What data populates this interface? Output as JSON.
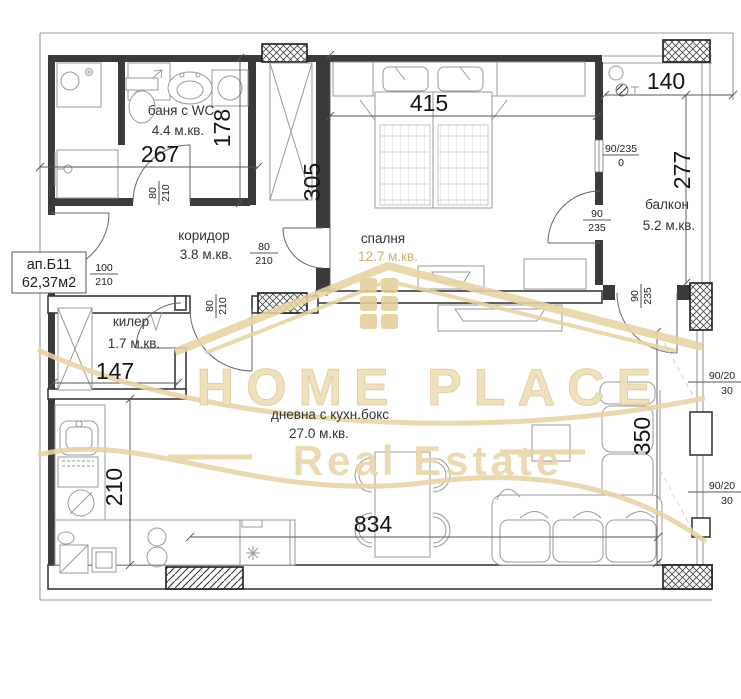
{
  "plan": {
    "unit_label": {
      "line1": "ап.Б11",
      "line2": "62,37м2"
    },
    "rooms": {
      "bathroom": {
        "name": "баня с WC",
        "area": "4.4 м.кв."
      },
      "corridor": {
        "name": "коридор",
        "area": "3.8 м.кв."
      },
      "bedroom": {
        "name": "спалня",
        "area": "12.7 м.кв."
      },
      "balcony": {
        "name": "балкон",
        "area": "5.2 м.кв."
      },
      "storage": {
        "name": "килер",
        "area": "1.7 м.кв."
      },
      "living": {
        "name": "дневна с кухн.бокс",
        "area": "27.0 м.кв."
      }
    },
    "dimensions": {
      "bath_width": "267",
      "bath_depth": "178",
      "bedroom_depth": "305",
      "bedroom_width": "415",
      "balcony_width": "140",
      "balcony_depth": "277",
      "storage_width": "147",
      "kitchen_depth": "210",
      "living_width": "834",
      "living_window": "350"
    },
    "openings": {
      "bath_door": {
        "w": "80",
        "h": "210"
      },
      "bedroom_door": {
        "w": "80",
        "h": "210"
      },
      "entrance_door": {
        "w": "100",
        "h": "210"
      },
      "living_door": {
        "w": "80",
        "h": "210"
      },
      "balcony_window": {
        "w": "90/235",
        "h": "0"
      },
      "bedroom_balcony_door": {
        "w": "90",
        "h": "235"
      },
      "living_balcony_door": {
        "w": "90",
        "h": "235"
      },
      "right_window_top": {
        "w": "90/20",
        "h": "30"
      },
      "right_window_bottom": {
        "w": "90/20",
        "h": "30"
      }
    },
    "watermark": {
      "title": "HOME PLACE",
      "subtitle": "Real Estate"
    },
    "colors": {
      "wall": "#3a3a3a",
      "furniture": "#9a9a9a",
      "watermark": "#e9d6a9",
      "bedroom_area_text": "#d2ab72"
    }
  }
}
